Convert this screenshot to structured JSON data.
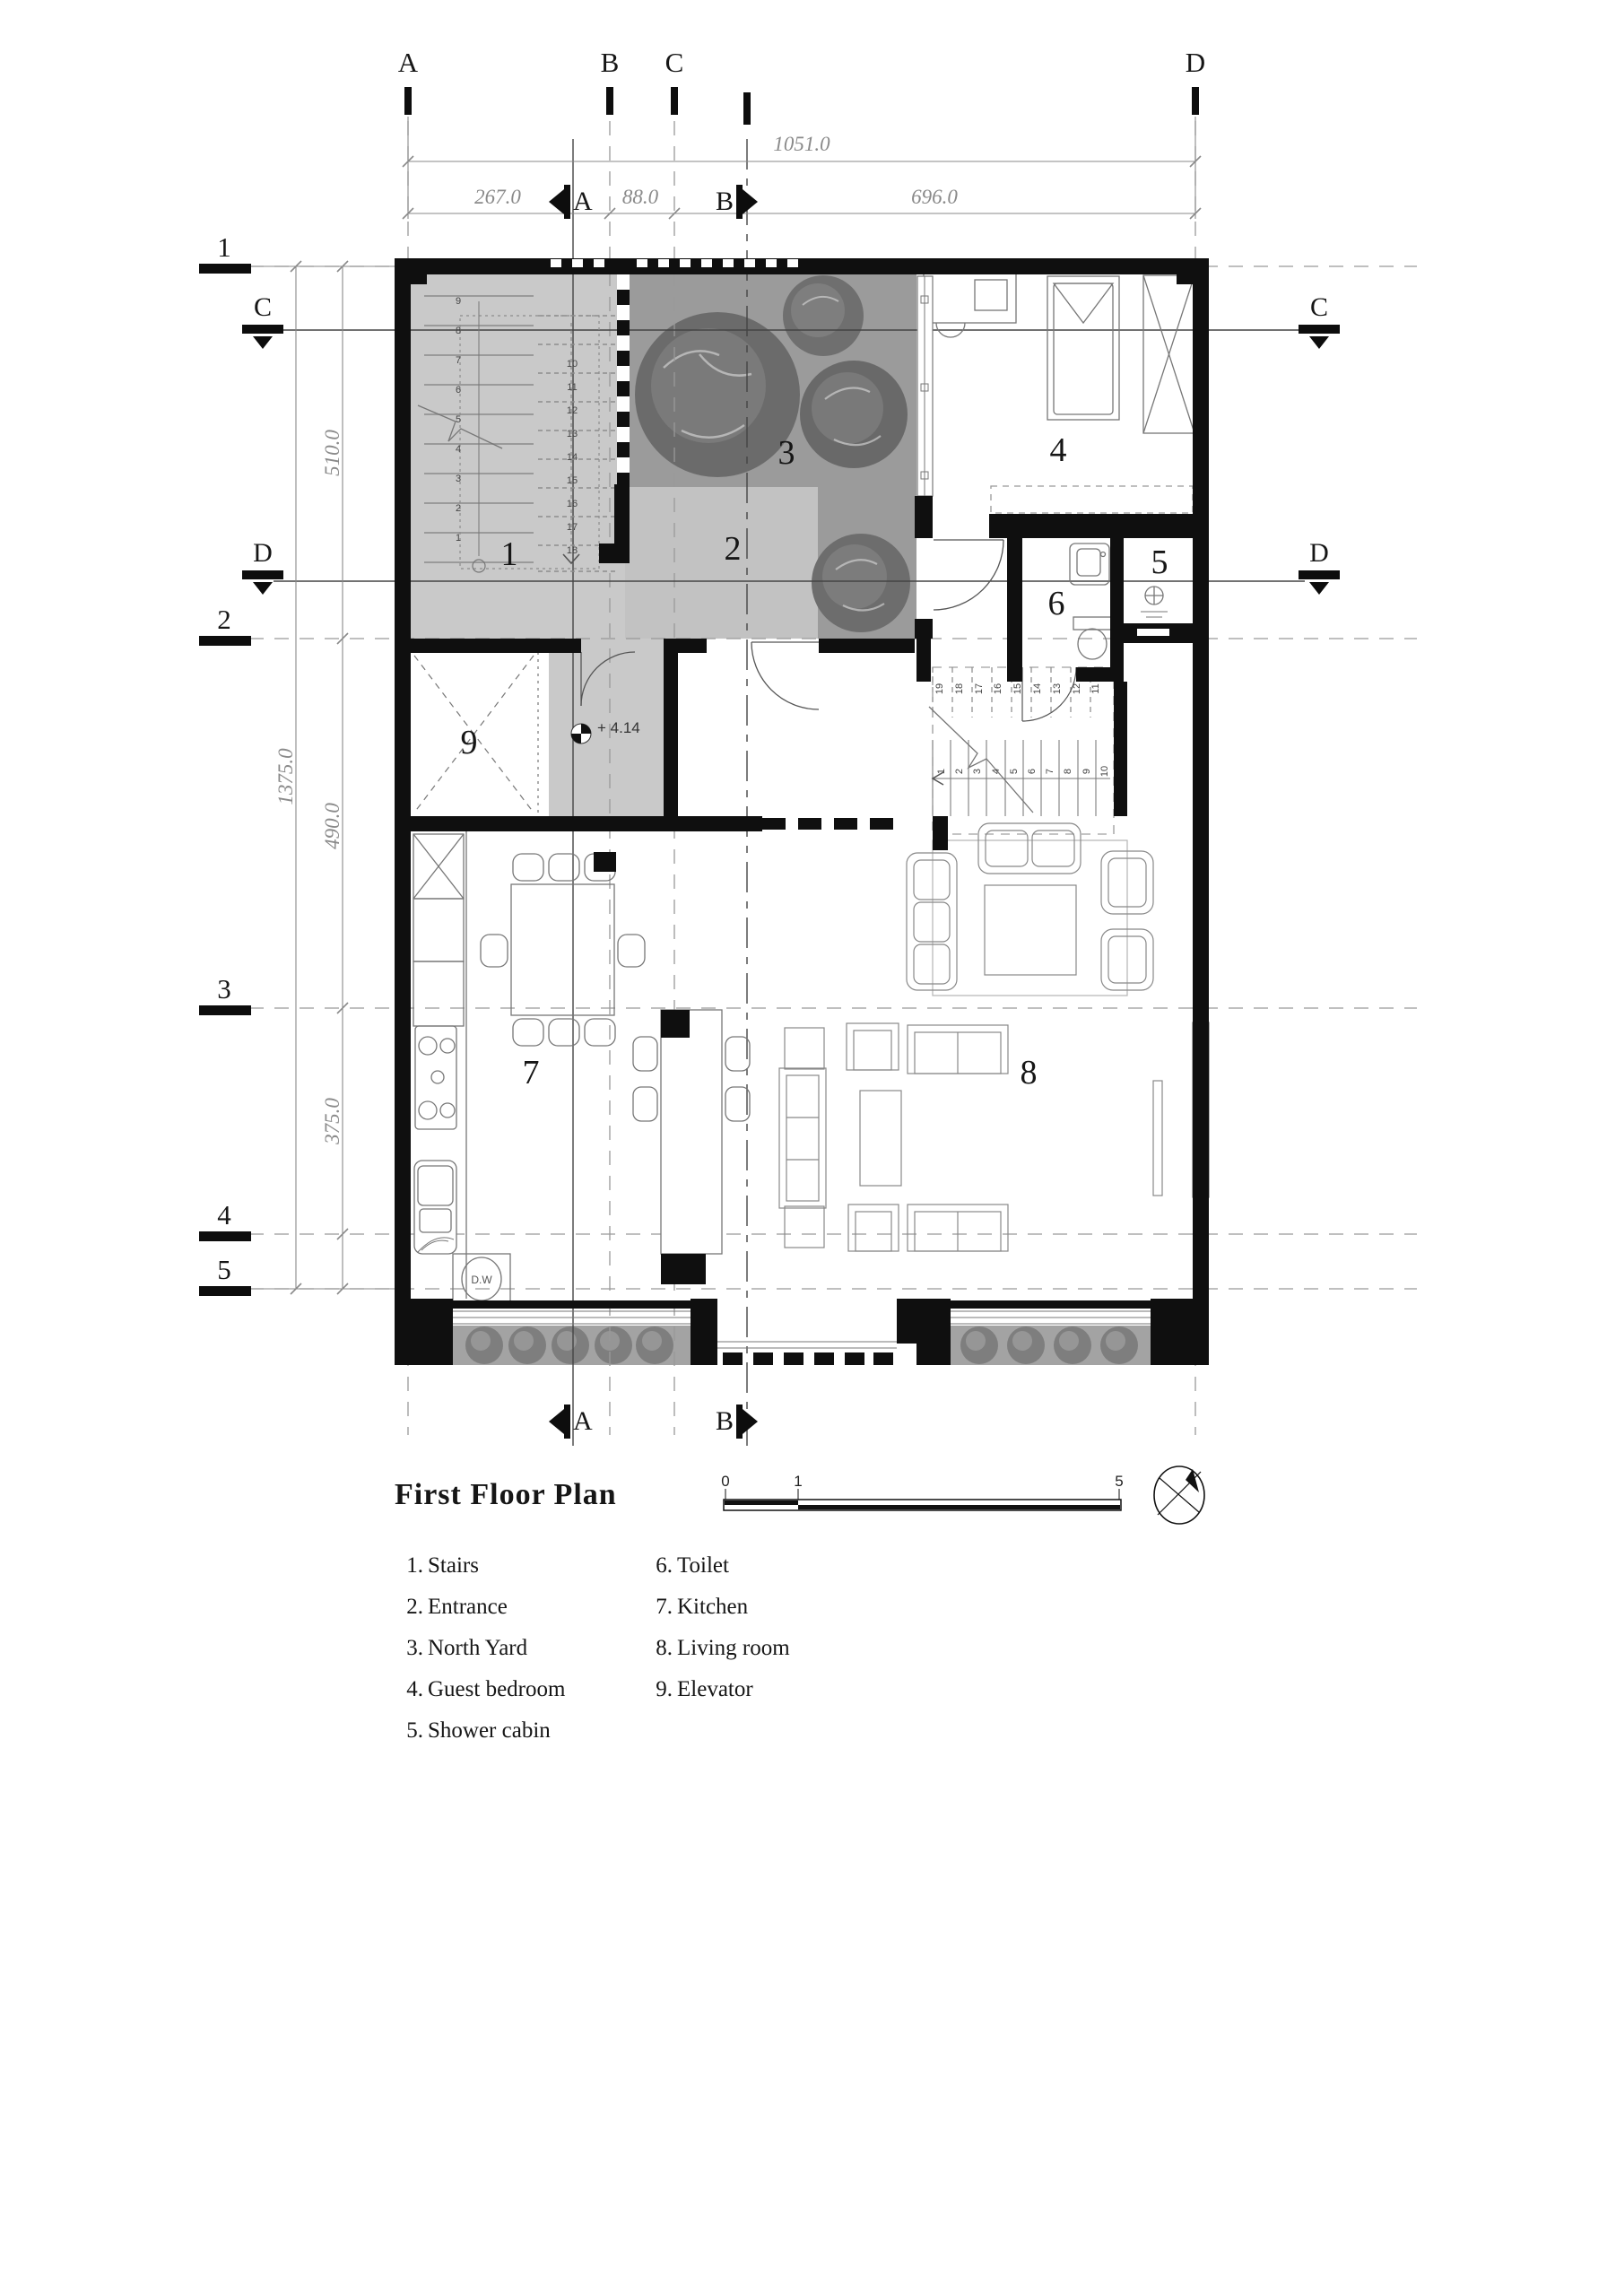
{
  "title": "First Floor Plan",
  "grid_columns": [
    "A",
    "B",
    "C",
    "D"
  ],
  "grid_rows": [
    "1",
    "2",
    "3",
    "4",
    "5"
  ],
  "dims": {
    "top_total": "1051.0",
    "top_segments": [
      "267.0",
      "88.0",
      "696.0"
    ],
    "left_total": "1375.0",
    "left_segments": [
      "510.0",
      "490.0",
      "375.0"
    ]
  },
  "section_markers": {
    "a": "A",
    "b": "B",
    "c": "C",
    "d": "D"
  },
  "level": "+ 4.14",
  "dw": "D.W",
  "scalebar": [
    "0",
    "1",
    "5"
  ],
  "rooms": {
    "r1": "1",
    "r2": "2",
    "r3": "3",
    "r4": "4",
    "r5": "5",
    "r6": "6",
    "r7": "7",
    "r8": "8",
    "r9": "9"
  },
  "legend": {
    "col1": [
      {
        "n": "1.",
        "label": "Stairs"
      },
      {
        "n": "2.",
        "label": "Entrance"
      },
      {
        "n": "3.",
        "label": "North Yard"
      },
      {
        "n": "4.",
        "label": "Guest bedroom"
      },
      {
        "n": "5.",
        "label": "Shower cabin"
      }
    ],
    "col2": [
      {
        "n": "6.",
        "label": "Toilet"
      },
      {
        "n": "7.",
        "label": "Kitchen"
      },
      {
        "n": "8.",
        "label": "Living room"
      },
      {
        "n": "9.",
        "label": "Elevator"
      }
    ]
  },
  "stairs": {
    "ext_left": [
      "9",
      "8",
      "7",
      "6",
      "5",
      "4",
      "3",
      "2",
      "1"
    ],
    "ext_right": [
      "10",
      "11",
      "12",
      "13",
      "14",
      "15",
      "16",
      "17",
      "18"
    ],
    "int_lower": [
      "1",
      "2",
      "3",
      "4",
      "5",
      "6",
      "7",
      "8",
      "9",
      "10"
    ],
    "int_upper": [
      "19",
      "18",
      "17",
      "16",
      "15",
      "14",
      "13",
      "12",
      "11"
    ]
  }
}
